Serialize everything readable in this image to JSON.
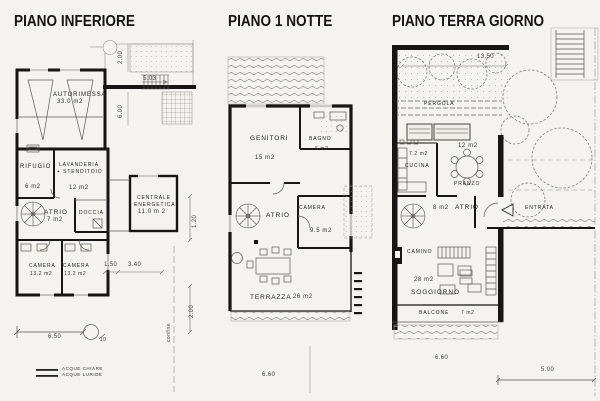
{
  "page": {
    "background": "#f4f3ef",
    "ink": "#161616"
  },
  "plan_inferiore": {
    "title": "PIANO INFERIORE",
    "rooms": {
      "autorimessa": {
        "name": "AUTORIMESSA",
        "area": "33.0  m2"
      },
      "rifugio": {
        "name": "RIFUGIO",
        "area": "6 m2"
      },
      "lavanderia": {
        "line1": "LAVANDERIA",
        "line2": "+ STENDITOIO",
        "area": "12 m2"
      },
      "centrale": {
        "line1": "CENTRALE",
        "line2": "ENERGETICA",
        "area": "11.0 m 2"
      },
      "atrio": {
        "name": "ATRIO",
        "area": "7 m2"
      },
      "doccia": {
        "name": "DOCCIA"
      },
      "camera1": {
        "name": "CAMERA",
        "area": "13.2 m2"
      },
      "camera2": {
        "name": "CAMERA",
        "area": "13.2 m2"
      }
    },
    "dims": {
      "top_200": "2.00",
      "top_503": "5.03",
      "top_600": "6.00",
      "right_120": "1.20",
      "mid_150": "1.50",
      "mid_340": "3.40",
      "right_200": "2.00",
      "bottom_650": "6.50",
      "bottom_10": "10",
      "confine": "confine"
    },
    "legend": [
      {
        "label": "ACQUE  CHIARE"
      },
      {
        "label": "ACQUE  LURIDE"
      }
    ]
  },
  "plan_notte": {
    "title": "PIANO 1 NOTTE",
    "rooms": {
      "genitori": {
        "name": "GENITORI",
        "area": "15 m2"
      },
      "bagno": {
        "name": "BAGNO",
        "area": "6 m2"
      },
      "atrio": {
        "name": "ATRIO"
      },
      "camera": {
        "name": "CAMERA",
        "area": "9.5 m2"
      },
      "terrazza": {
        "name": "TERRAZZA",
        "area": "26  m2"
      }
    },
    "dims": {
      "bottom_660": "6.60"
    }
  },
  "plan_giorno": {
    "title": "PIANO TERRA GIORNO",
    "rooms": {
      "pergola": {
        "name": "PERGOLA"
      },
      "cucina": {
        "name": "CUCINA",
        "area": "7.2 m2"
      },
      "pranzo": {
        "name": "PRANZO",
        "area": "12  m2"
      },
      "atrio": {
        "name": "ATRIO",
        "area": "8 m2"
      },
      "entrata": {
        "name": "ENTRATA"
      },
      "camino": {
        "name": "CAMINO"
      },
      "soggiorno": {
        "name": "SOGGIORNO",
        "area": "28  m2"
      },
      "balcone": {
        "name": "BALCONE",
        "area": "7 m2"
      }
    },
    "dims": {
      "top_1350": "13.50",
      "bottom_660": "6.60",
      "bottom_500": "5.00"
    }
  }
}
